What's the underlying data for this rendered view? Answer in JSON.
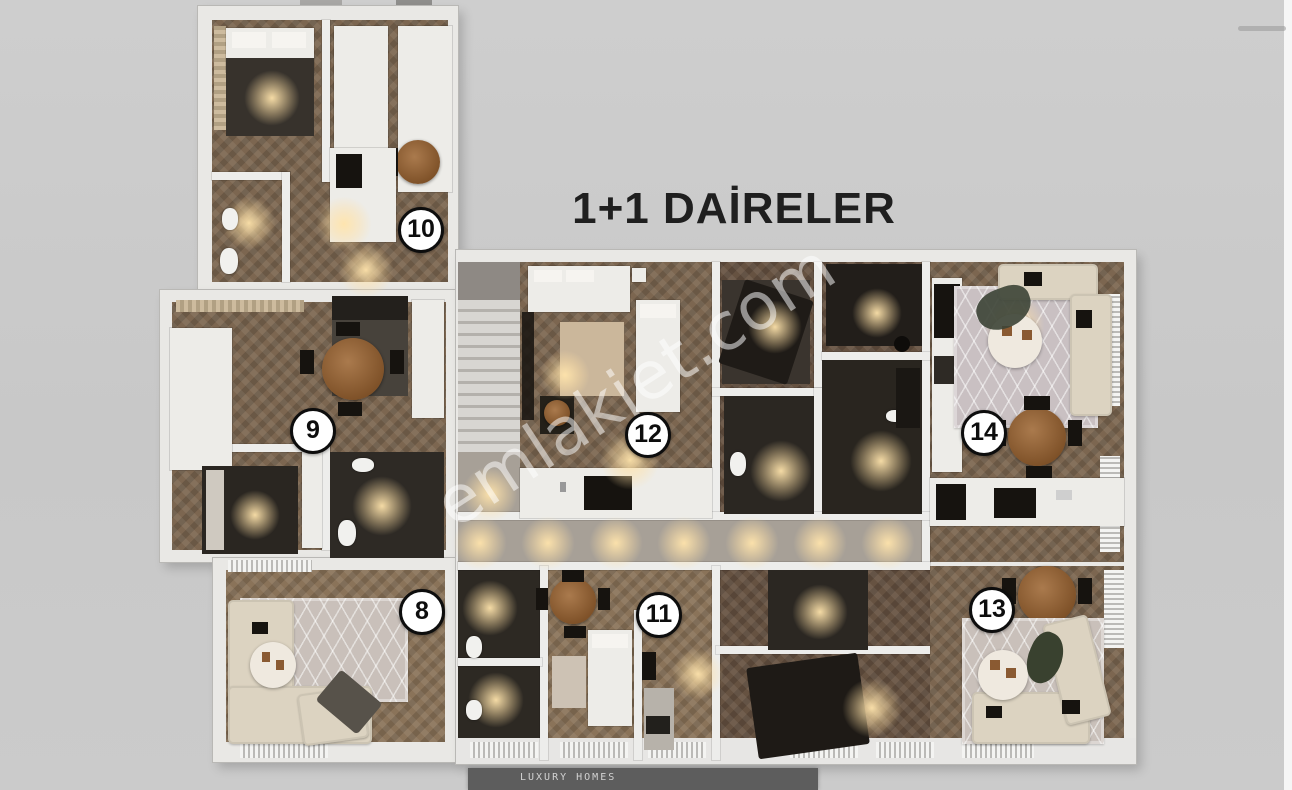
{
  "title": "1+1 DAİRELER",
  "watermark": "emlakjet.com",
  "footer": {
    "brand": "LUXURY HOMES"
  },
  "units": {
    "u8": "8",
    "u9": "9",
    "u10": "10",
    "u11": "11",
    "u12": "12",
    "u13": "13",
    "u14": "14"
  },
  "palette": {
    "background": "#c9c9c9",
    "wall": "#ededeb",
    "wood_floor": "#7c6650",
    "dark_room": "#2d2923",
    "corridor": "#a7a097",
    "badge_bg": "#ffffff",
    "badge_border": "#0d0d0d",
    "title_color": "#1f1f1f",
    "footer_bar": "#5d5d5d"
  }
}
